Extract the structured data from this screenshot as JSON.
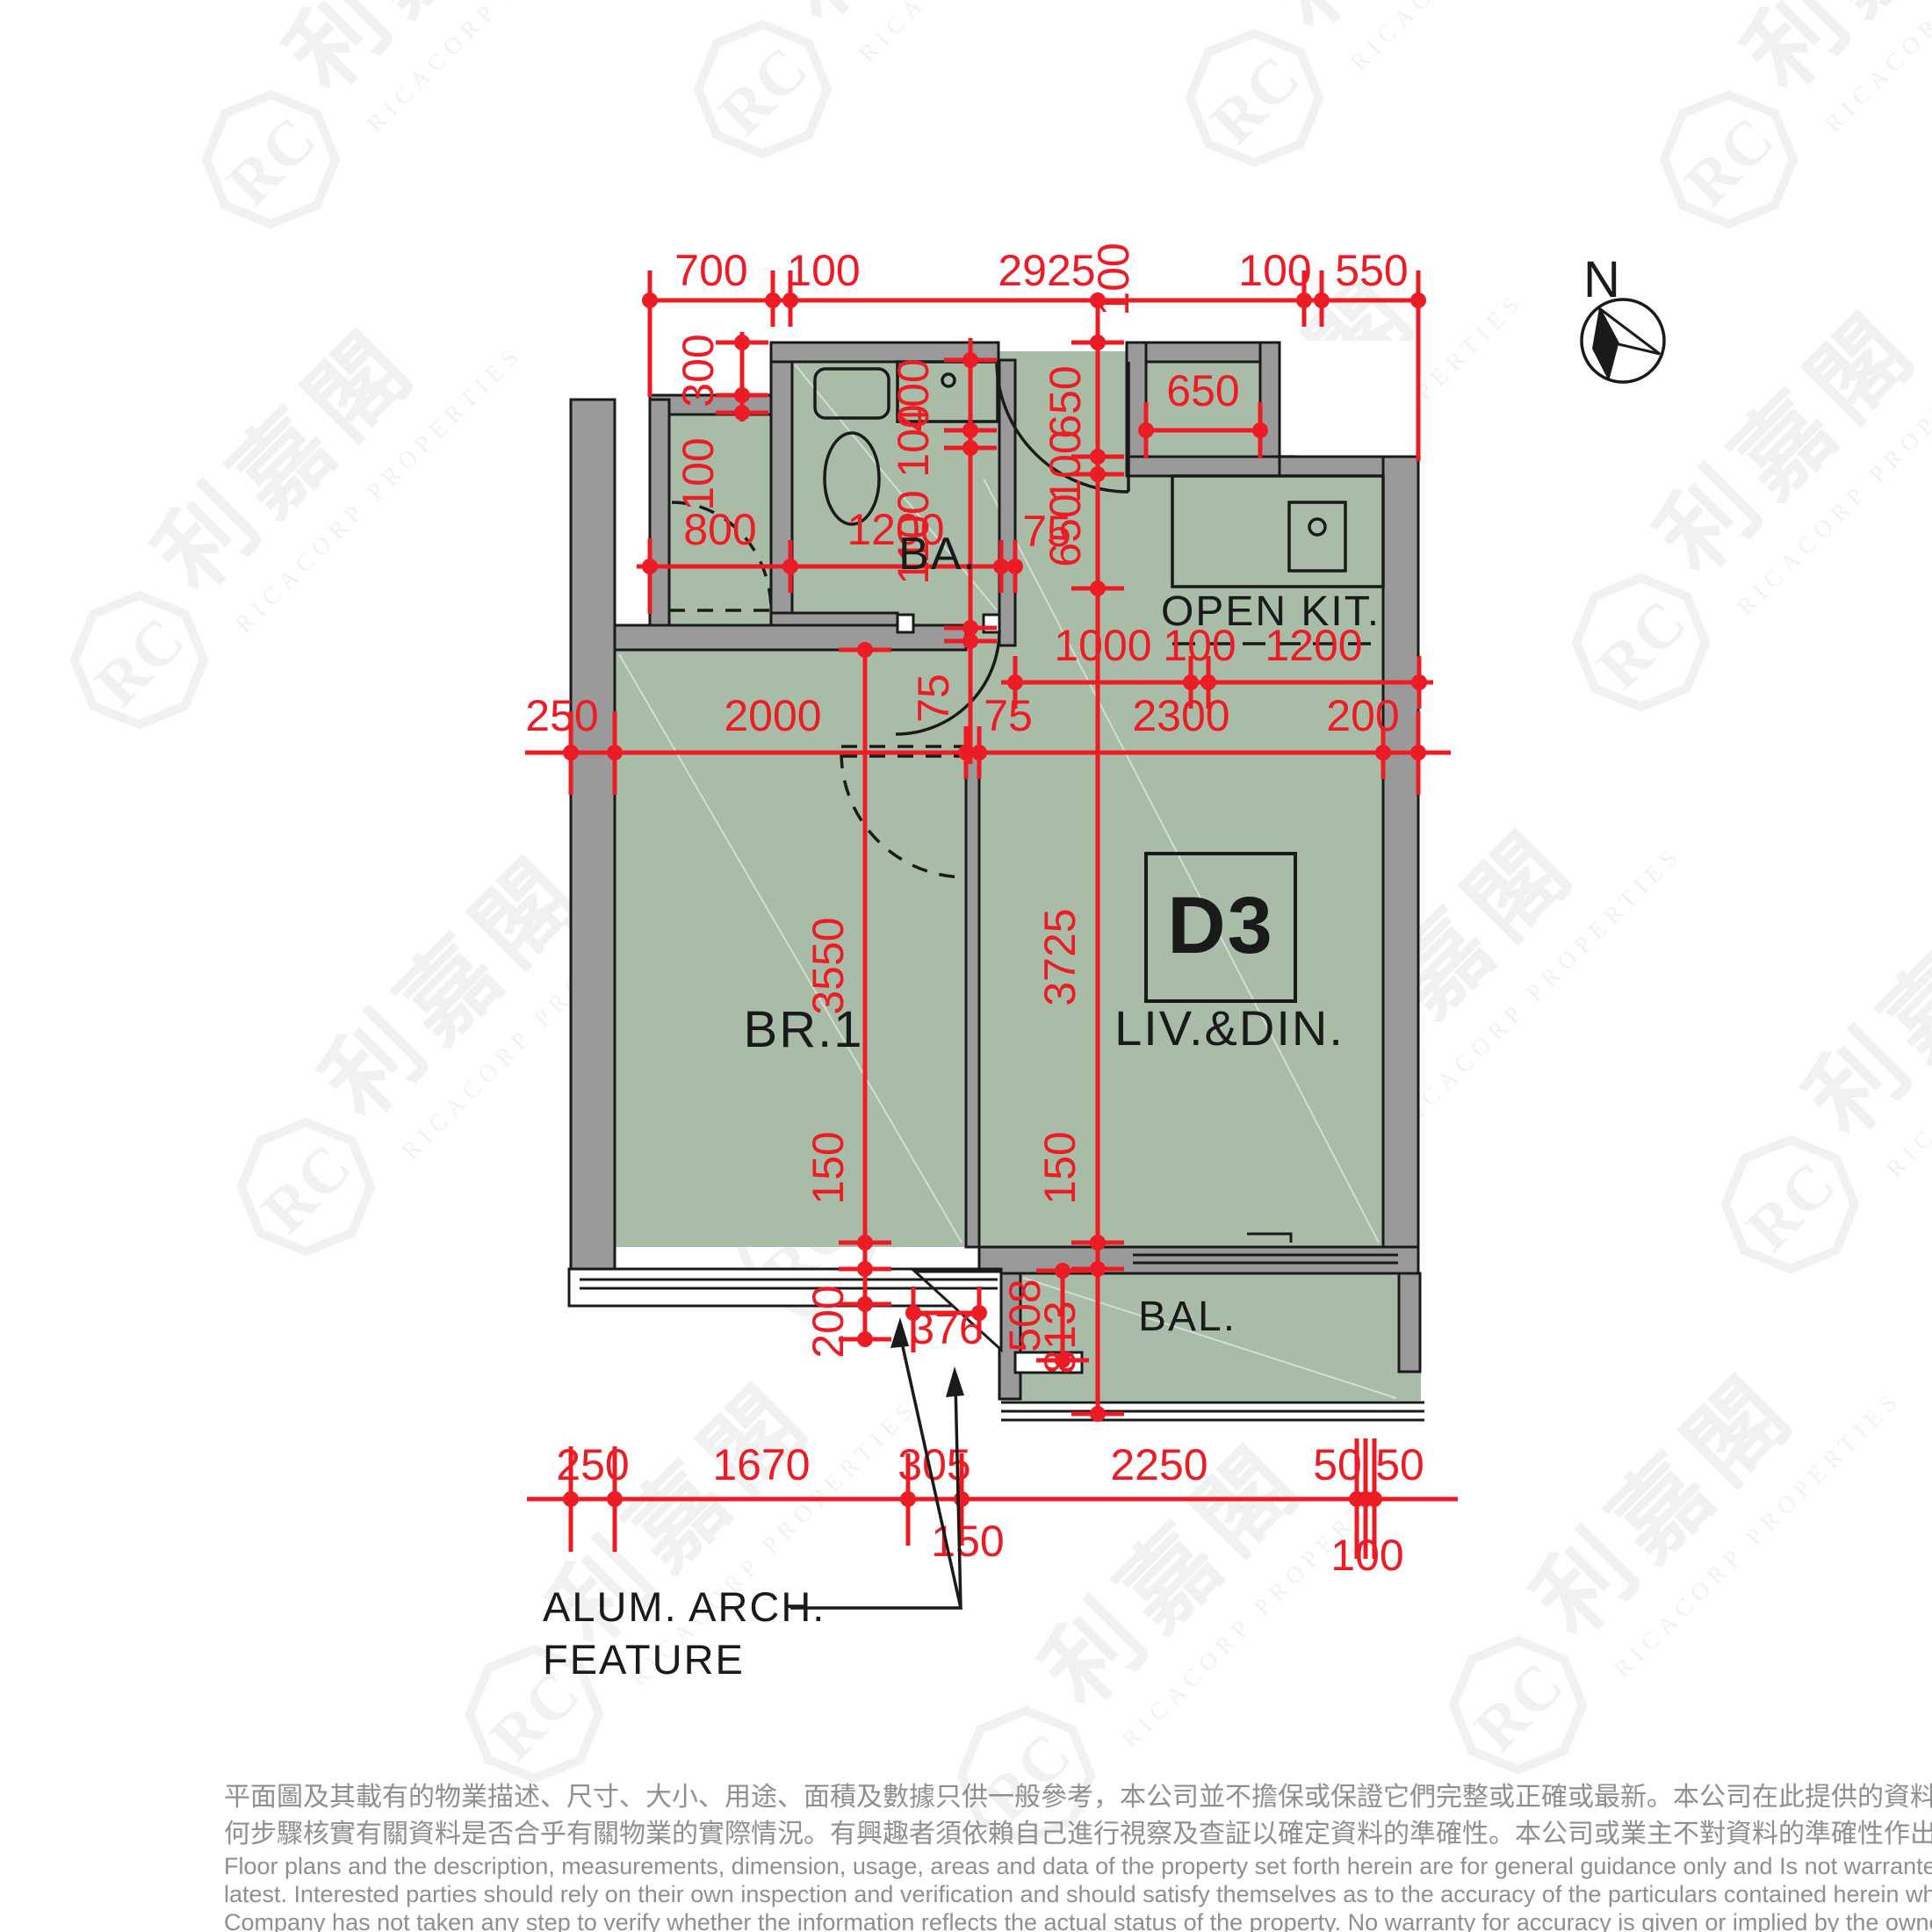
{
  "unit": {
    "flat": "D3",
    "bedroom": "BR.1",
    "living": "LIV.&DIN.",
    "bathroom": "BA.",
    "kitchen": "OPEN KIT.",
    "balcony": "BAL."
  },
  "north_label": "N",
  "annotation": {
    "line1": "ALUM. ARCH.",
    "line2": "FEATURE"
  },
  "dims": {
    "top": [
      "700",
      "100",
      "2925",
      "100",
      "550"
    ],
    "top_offset": "100",
    "closet_v": [
      "300",
      "100"
    ],
    "closet_h": [
      "800",
      "1200",
      "75"
    ],
    "bath_v": [
      "400",
      "100",
      "1100"
    ],
    "wall_v": "75",
    "entry_v": [
      "650",
      "100",
      "650"
    ],
    "store_w": "650",
    "kit_h": [
      "1000",
      "100",
      "1200"
    ],
    "mid_h": [
      "250",
      "2000",
      "75",
      "2300",
      "200"
    ],
    "br1_v": [
      "3550",
      "150",
      "200"
    ],
    "liv_v": [
      "3725",
      "150"
    ],
    "bal_v": [
      "508",
      "813"
    ],
    "notch_w": "376",
    "bottom_h": [
      "250",
      "1670",
      "305",
      "2250",
      "50",
      "50"
    ],
    "bottom_sub": [
      "150",
      "100"
    ]
  },
  "watermark": {
    "cjk": "利嘉閣",
    "latin": "RICACORP PROPERTIES",
    "logo": "RC"
  },
  "disclaimer": {
    "zh1": "平面圖及其載有的物業描述、尺寸、大小、用途、面積及數據只供一般參考，本公司並不擔保或保證它們完整或正確或最新。本公司在此提供的資料只供閣下參考，本公司並無採取任",
    "zh2": "何步驟核實有關資料是否合乎有關物業的實際情況。有興趣者須依賴自己進行視察及查証以確定資料的準確性。本公司或業主不對資料的準確性作出任何明示或隱含的保證。",
    "en1": "Floor plans and the description, measurements, dimension, usage, areas and data of the property set forth herein are for general guidance only and Is not warranted or guaranteed to be complete or correct or the",
    "en2": "latest. Interested parties should rely on their own inspection and verification and should satisfy themselves as to the accuracy of the particulars contained herein which are provided by us for information only.  Our",
    "en3": "Company has not taken any step to verify whether the information reflects the actual status of the property.  No warranty for accuracy is given or implied by the owners or us."
  },
  "colors": {
    "floor": "#a8bca8",
    "wall": "#9a9a9a",
    "line": "#1a1a1a",
    "dim": "#ed1c24",
    "watermark": "#e5e5e5",
    "disclaimer": "#8f8f8f"
  }
}
